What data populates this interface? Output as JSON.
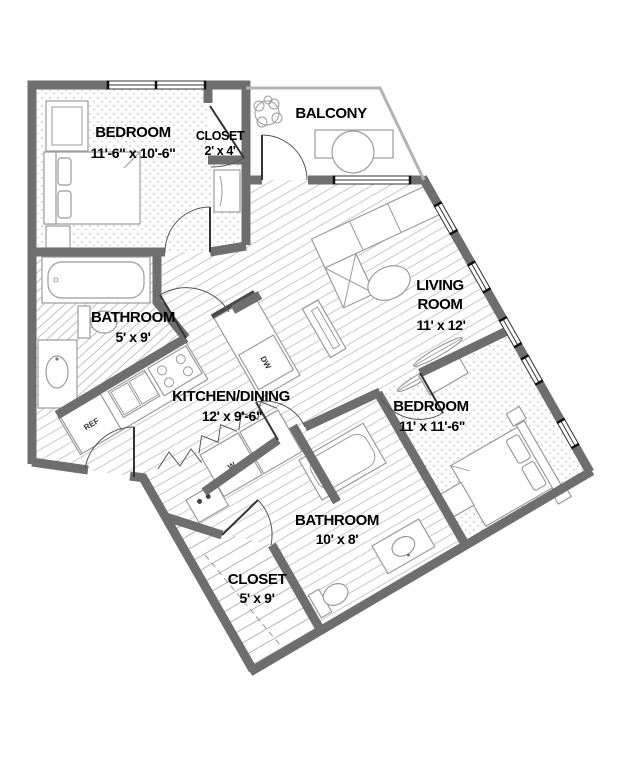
{
  "rooms": {
    "bedroom1": {
      "name": "BEDROOM",
      "dims": "11'-6\" x 10'-6\""
    },
    "closet1": {
      "name": "CLOSET",
      "dims": "2' x 4'"
    },
    "balcony": {
      "name": "BALCONY"
    },
    "living": {
      "name": "LIVING",
      "name2": "ROOM",
      "dims": "11' x 12'"
    },
    "kitchen": {
      "name": "KITCHEN/DINING",
      "dims": "12' x 9'-6\""
    },
    "bathroom1": {
      "name": "BATHROOM",
      "dims": "5' x 9'"
    },
    "bedroom2": {
      "name": "BEDROOM",
      "dims": "11' x 11'-6\""
    },
    "bathroom2": {
      "name": "BATHROOM",
      "dims": "10' x 8'"
    },
    "closet2": {
      "name": "CLOSET",
      "dims": "5' x 9'"
    }
  },
  "appliances": {
    "refrigerator": "REF",
    "dishwasher": "DW",
    "washer": "W",
    "dryer": "DR"
  },
  "colors": {
    "wall": "#6e6e6e",
    "floor_line": "#c9c9c9",
    "text": "#000000"
  }
}
